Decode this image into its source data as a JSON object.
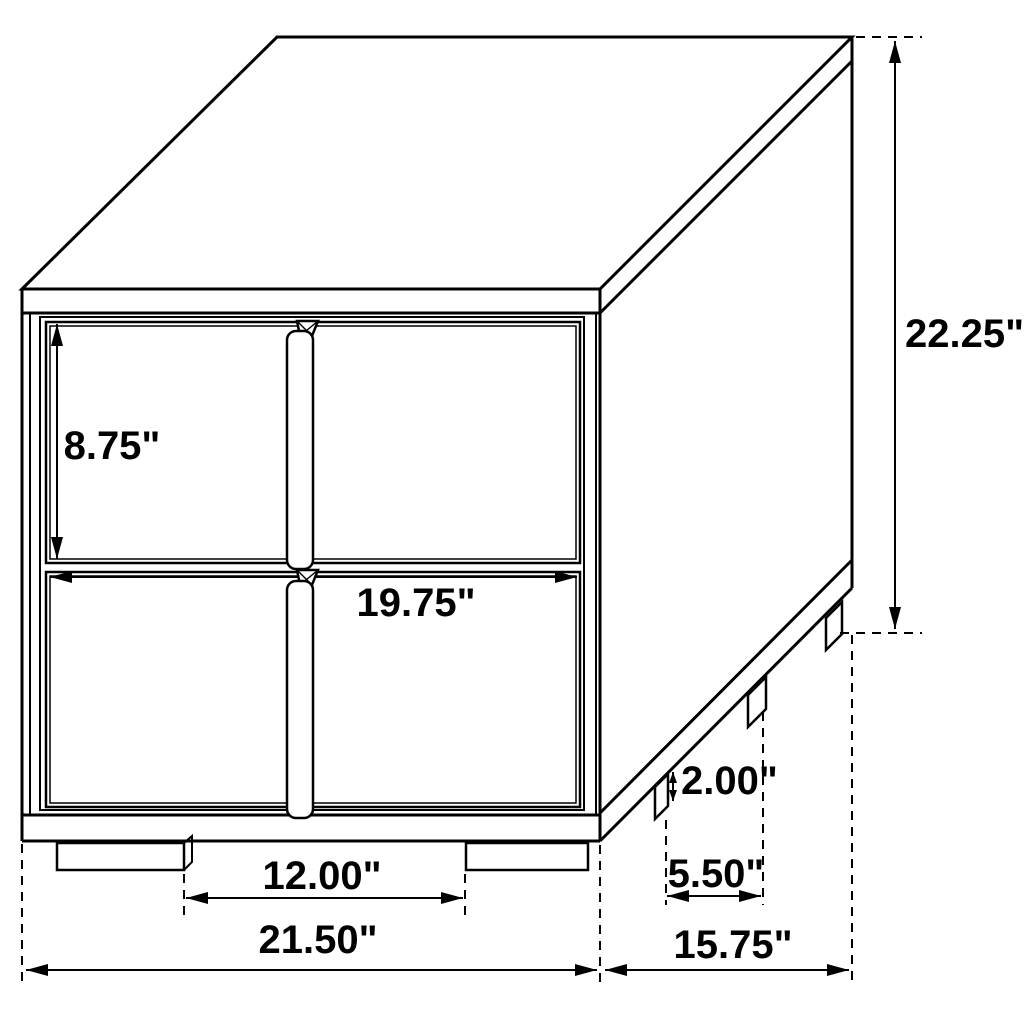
{
  "drawing": {
    "name": "nightstand-dimension-diagram",
    "style": "black-and-white technical line drawing",
    "background_color": "#ffffff",
    "line_color": "#000000",
    "unit": "inches"
  },
  "dims": {
    "drawer_height": "8.75\"",
    "drawer_width": "19.75\"",
    "overall_height": "22.25\"",
    "leg_height": "2.00\"",
    "front_leg_span": "12.00\"",
    "side_leg_span": "5.50\"",
    "overall_width": "21.50\"",
    "overall_depth": "15.75\""
  }
}
